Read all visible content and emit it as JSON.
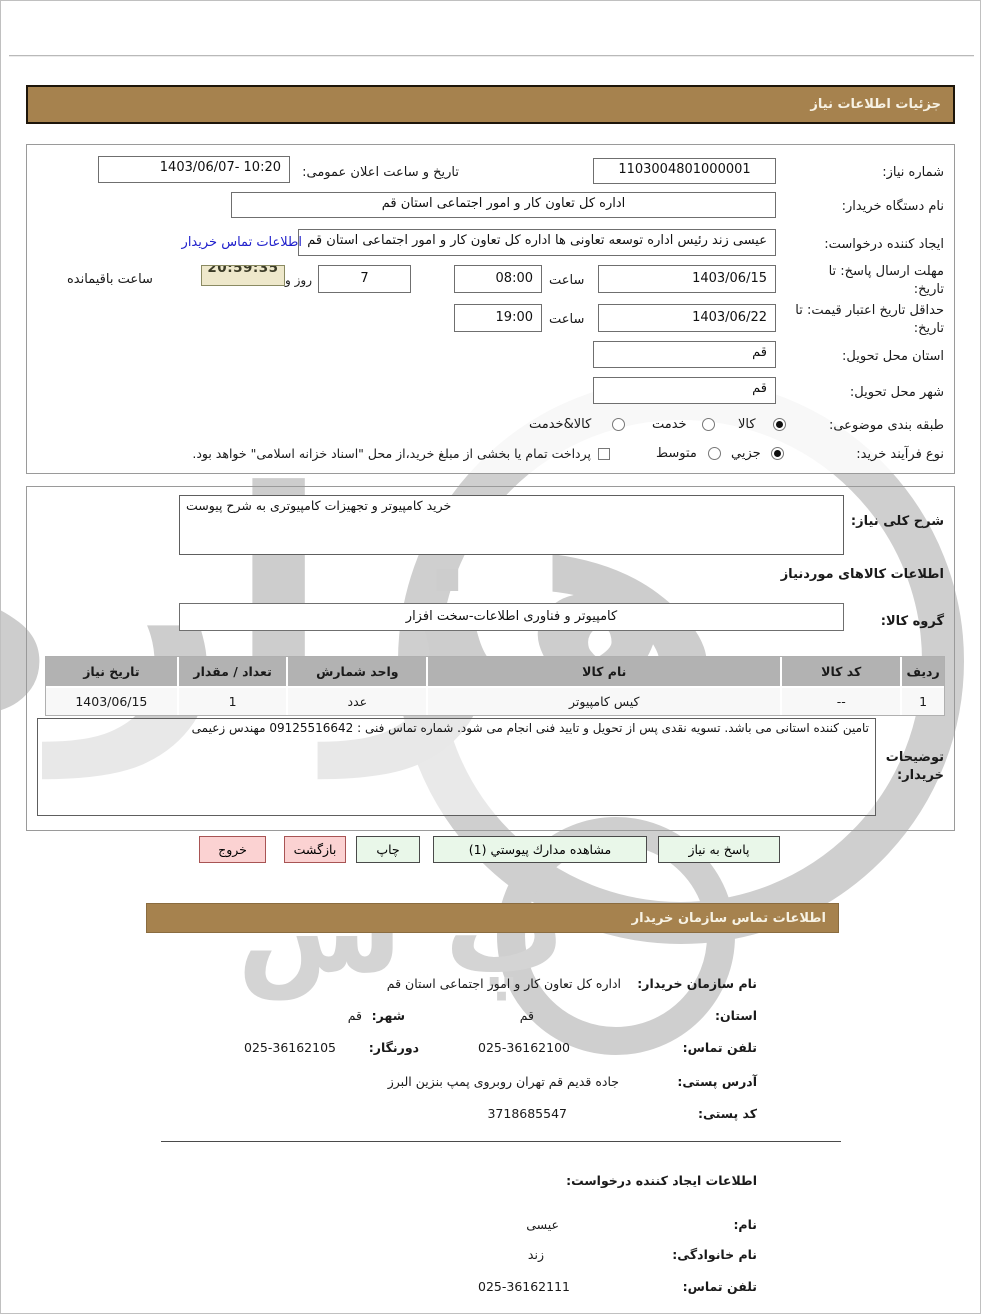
{
  "headers": {
    "details_bar": "جزئیات اطلاعات نیاز",
    "contact_bar": "اطلاعات تماس سازمان خریدار"
  },
  "form": {
    "need_number": {
      "label": "شماره نیاز:",
      "value": "1103004801000001"
    },
    "announce": {
      "label": "تاریخ و ساعت اعلان عمومی:",
      "value": "1403/06/07- 10:20"
    },
    "buyer_org": {
      "label": "نام دستگاه خریدار:",
      "value": "اداره کل تعاون کار و امور اجتماعی استان قم"
    },
    "creator": {
      "label": "ایجاد کننده درخواست:",
      "value": "عیسی زند رئیس اداره توسعه تعاونی ها اداره کل تعاون کار و امور اجتماعی استان قم",
      "link": "اطلاعات تماس خریدار"
    },
    "deadline": {
      "label": "مهلت ارسال پاسخ: تا تاریخ:",
      "date": "1403/06/15",
      "time_label": "ساعت",
      "time": "08:00",
      "days": "7",
      "days_label": "روز و",
      "countdown": "20:59:35",
      "countdown_label": "ساعت باقیمانده"
    },
    "validity": {
      "label": "حداقل تاریخ اعتبار قیمت: تا تاریخ:",
      "date": "1403/06/22",
      "time_label": "ساعت",
      "time": "19:00"
    },
    "province": {
      "label": "استان محل تحویل:",
      "value": "قم"
    },
    "city": {
      "label": "شهر محل تحویل:",
      "value": "قم"
    },
    "classification": {
      "label": "طبقه بندی موضوعی:",
      "options": [
        {
          "label": "کالا",
          "selected": true
        },
        {
          "label": "خدمت",
          "selected": false
        },
        {
          "label": "کالا&خدمت",
          "selected": false
        }
      ]
    },
    "process": {
      "label": "نوع فرآیند خرید:",
      "options": [
        {
          "label": "جزیي",
          "selected": true
        },
        {
          "label": "متوسط",
          "selected": false
        }
      ],
      "checkbox_label": "پرداخت تمام یا بخشی از مبلغ خرید،از محل \"اسناد خزانه اسلامی\" خواهد بود.",
      "checkbox_checked": false
    }
  },
  "need": {
    "desc_label": "شرح کلی نیاز:",
    "desc_value": "خرید کامپیوتر و تجهیزات کامپیوتری به شرح پیوست",
    "goods_heading": "اطلاعات کالاهای موردنیاز",
    "group_label": "گروه کالا:",
    "group_value": "کامپیوتر و فناوری اطلاعات-سخت افزار",
    "table": {
      "headers": [
        "ردیف",
        "کد کالا",
        "نام کالا",
        "واحد شمارش",
        "تعداد / مقدار",
        "تاریخ نیاز"
      ],
      "rows": [
        [
          "1",
          "--",
          "کیس کامپیوتر",
          "عدد",
          "1",
          "1403/06/15"
        ]
      ]
    },
    "notes_label": "توضیحات خریدار:",
    "notes_value": "تامین کننده استانی می باشد. تسویه نقدی پس از تحویل و تایید فنی انجام می شود. شماره تماس فنی : 09125516642 مهندس زعیمی"
  },
  "buttons": {
    "respond": "پاسخ به نیاز",
    "attachments": "مشاهده مدارك پیوستي (1)",
    "print": "چاپ",
    "back": "بازگشت",
    "exit": "خروج"
  },
  "contact": {
    "org": {
      "label": "نام سازمان خریدار:",
      "value": "اداره کل تعاون کار و امور اجتماعی استان قم"
    },
    "province": {
      "label": "استان:",
      "value": "قم"
    },
    "city": {
      "label": "شهر:",
      "value": "قم"
    },
    "phone": {
      "label": "تلفن تماس:",
      "value": "025-36162100"
    },
    "fax": {
      "label": "دورنگار:",
      "value": "025-36162105"
    },
    "address": {
      "label": "آدرس پستی:",
      "value": "جاده قدیم قم تهران روبروی پمپ بنزین البرز"
    },
    "postal": {
      "label": "کد پستی:",
      "value": "3718685547"
    },
    "creator_heading": "اطلاعات ایجاد کننده درخواست:",
    "first_name": {
      "label": "نام:",
      "value": "عیسی"
    },
    "last_name": {
      "label": "نام خانوادگی:",
      "value": "زند"
    },
    "creator_phone": {
      "label": "تلفن تماس:",
      "value": "025-36162111"
    }
  }
}
